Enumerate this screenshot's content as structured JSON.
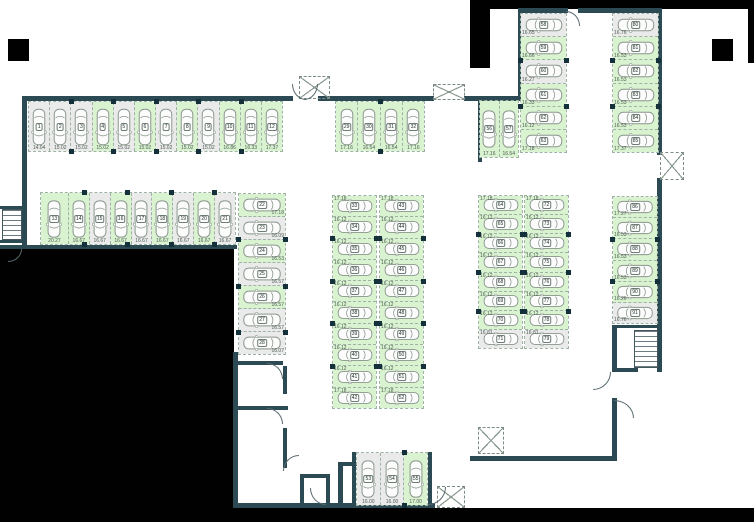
{
  "plan": {
    "type": "parking-floor-plan",
    "colors": {
      "available_stall": "#d9f2cf",
      "occupied_stall": "#eaeaea",
      "wall": "#2c4a54",
      "outside": "#010101",
      "floor": "#ffffff"
    },
    "groups": [
      {
        "id": "row-top-left",
        "dir": "row",
        "orient": "v",
        "x": 28,
        "y": 101,
        "w": 255,
        "h": 51,
        "sizePos": "bottom",
        "stalls": [
          {
            "n": "1",
            "size": "14.04",
            "green": false
          },
          {
            "n": "2",
            "size": "15.02",
            "green": false
          },
          {
            "n": "3",
            "size": "15.02",
            "green": false
          },
          {
            "n": "4",
            "size": "15.02",
            "green": true
          },
          {
            "n": "5",
            "size": "15.02",
            "green": false
          },
          {
            "n": "6",
            "size": "15.02",
            "green": true
          },
          {
            "n": "7",
            "size": "15.02",
            "green": false
          },
          {
            "n": "8",
            "size": "15.02",
            "green": true
          },
          {
            "n": "9",
            "size": "15.02",
            "green": false
          },
          {
            "n": "10",
            "size": "16.86",
            "green": true
          },
          {
            "n": "11",
            "size": "16.33",
            "green": true
          },
          {
            "n": "12",
            "size": "17.37",
            "green": true
          }
        ]
      },
      {
        "id": "row-second-left",
        "dir": "row",
        "orient": "v",
        "x": 40,
        "y": 192,
        "w": 196,
        "h": 53,
        "sizePos": "bottom",
        "stalls": [
          {
            "n": "13",
            "size": "20.27",
            "green": true,
            "f": 1.35
          },
          {
            "n": "14",
            "size": "16.67",
            "green": true
          },
          {
            "n": "15",
            "size": "16.67",
            "green": false
          },
          {
            "n": "16",
            "size": "16.67",
            "green": true
          },
          {
            "n": "17",
            "size": "16.67",
            "green": false
          },
          {
            "n": "18",
            "size": "16.67",
            "green": true
          },
          {
            "n": "19",
            "size": "16.67",
            "green": false
          },
          {
            "n": "20",
            "size": "16.67",
            "green": true
          },
          {
            "n": "21",
            "size": "16.67",
            "green": false
          }
        ]
      },
      {
        "id": "col-left",
        "dir": "col",
        "orient": "h",
        "x": 238,
        "y": 193,
        "w": 48,
        "h": 162,
        "sizePos": "br",
        "stalls": [
          {
            "n": "22",
            "size": "17.18",
            "green": true
          },
          {
            "n": "23",
            "size": "16.09",
            "green": false
          },
          {
            "n": "24",
            "size": "16.53",
            "green": true
          },
          {
            "n": "25",
            "size": "16.57",
            "green": false
          },
          {
            "n": "26",
            "size": "16.57",
            "green": true
          },
          {
            "n": "27",
            "size": "16.57",
            "green": false
          },
          {
            "n": "28",
            "size": "16.07",
            "green": false
          }
        ]
      },
      {
        "id": "row-mid-top",
        "dir": "row",
        "orient": "v",
        "x": 335,
        "y": 101,
        "w": 90,
        "h": 51,
        "sizePos": "bottom",
        "stalls": [
          {
            "n": "29",
            "size": "17.16",
            "green": true
          },
          {
            "n": "30",
            "size": "16.54",
            "green": true
          },
          {
            "n": "31",
            "size": "16.54",
            "green": true
          },
          {
            "n": "32",
            "size": "17.16",
            "green": true
          }
        ]
      },
      {
        "id": "col-mid-a",
        "dir": "col",
        "orient": "h",
        "x": 332,
        "y": 195,
        "w": 45,
        "h": 214,
        "sizePos": "tl",
        "stalls": [
          {
            "n": "33",
            "size": "17.18",
            "green": true
          },
          {
            "n": "34",
            "size": "16.12",
            "green": true
          },
          {
            "n": "35",
            "size": "16.12",
            "green": true
          },
          {
            "n": "36",
            "size": "16.12",
            "green": true
          },
          {
            "n": "37",
            "size": "16.12",
            "green": true
          },
          {
            "n": "38",
            "size": "16.12",
            "green": true
          },
          {
            "n": "39",
            "size": "16.12",
            "green": true
          },
          {
            "n": "40",
            "size": "16.12",
            "green": true
          },
          {
            "n": "41",
            "size": "16.12",
            "green": true
          },
          {
            "n": "42",
            "size": "17.18",
            "green": true
          }
        ]
      },
      {
        "id": "col-mid-b",
        "dir": "col",
        "orient": "h",
        "x": 379,
        "y": 195,
        "w": 45,
        "h": 214,
        "sizePos": "tl",
        "stalls": [
          {
            "n": "43",
            "size": "17.18",
            "green": true
          },
          {
            "n": "44",
            "size": "16.12",
            "green": true
          },
          {
            "n": "45",
            "size": "16.12",
            "green": true
          },
          {
            "n": "46",
            "size": "16.12",
            "green": true
          },
          {
            "n": "47",
            "size": "16.12",
            "green": true
          },
          {
            "n": "48",
            "size": "16.12",
            "green": true
          },
          {
            "n": "49",
            "size": "16.12",
            "green": true
          },
          {
            "n": "50",
            "size": "16.12",
            "green": true
          },
          {
            "n": "51",
            "size": "16.12",
            "green": true
          },
          {
            "n": "52",
            "size": "17.18",
            "green": true
          }
        ]
      },
      {
        "id": "row-bottom-center",
        "dir": "row",
        "orient": "v",
        "x": 356,
        "y": 452,
        "w": 72,
        "h": 54,
        "sizePos": "bottom",
        "stalls": [
          {
            "n": "53",
            "size": "16.00",
            "green": false
          },
          {
            "n": "54",
            "size": "16.00",
            "green": false
          },
          {
            "n": "55",
            "size": "17.00",
            "green": true
          }
        ]
      },
      {
        "id": "pair-top-right",
        "dir": "row",
        "orient": "v",
        "x": 479,
        "y": 100,
        "w": 40,
        "h": 58,
        "sizePos": "bottom",
        "stalls": [
          {
            "n": "56",
            "size": "17.16",
            "green": true
          },
          {
            "n": "57",
            "size": "16.54",
            "green": true
          }
        ]
      },
      {
        "id": "col-wing-left",
        "dir": "col",
        "orient": "h",
        "x": 520,
        "y": 13,
        "w": 47,
        "h": 140,
        "sizePos": "bl",
        "stalls": [
          {
            "n": "58",
            "size": "16.65",
            "green": false
          },
          {
            "n": "59",
            "size": "16.66",
            "green": true
          },
          {
            "n": "60",
            "size": "16.27",
            "green": false
          },
          {
            "n": "61",
            "size": "16.33",
            "green": true
          },
          {
            "n": "62",
            "size": "16.12",
            "green": true
          },
          {
            "n": "63",
            "size": "17.18",
            "green": true
          }
        ]
      },
      {
        "id": "col-wing-right",
        "dir": "col",
        "orient": "h",
        "x": 612,
        "y": 13,
        "w": 47,
        "h": 140,
        "sizePos": "bl",
        "stalls": [
          {
            "n": "80",
            "size": "16.76",
            "green": false
          },
          {
            "n": "81",
            "size": "16.53",
            "green": true
          },
          {
            "n": "82",
            "size": "16.53",
            "green": true
          },
          {
            "n": "83",
            "size": "16.53",
            "green": true
          },
          {
            "n": "84",
            "size": "16.53",
            "green": true
          },
          {
            "n": "85",
            "size": "17.37",
            "green": true
          }
        ]
      },
      {
        "id": "col-right-a",
        "dir": "col",
        "orient": "h",
        "x": 478,
        "y": 195,
        "w": 45,
        "h": 154,
        "sizePos": "tl",
        "stalls": [
          {
            "n": "64",
            "size": "17.18",
            "green": true
          },
          {
            "n": "65",
            "size": "16.12",
            "green": true
          },
          {
            "n": "66",
            "size": "16.12",
            "green": true
          },
          {
            "n": "67",
            "size": "16.12",
            "green": true
          },
          {
            "n": "68",
            "size": "16.12",
            "green": true
          },
          {
            "n": "69",
            "size": "16.12",
            "green": true
          },
          {
            "n": "70",
            "size": "16.12",
            "green": true
          },
          {
            "n": "71",
            "size": "16.81",
            "green": false
          }
        ]
      },
      {
        "id": "col-right-b",
        "dir": "col",
        "orient": "h",
        "x": 524,
        "y": 195,
        "w": 45,
        "h": 154,
        "sizePos": "tl",
        "stalls": [
          {
            "n": "72",
            "size": "17.18",
            "green": true
          },
          {
            "n": "73",
            "size": "16.12",
            "green": true
          },
          {
            "n": "74",
            "size": "16.12",
            "green": true
          },
          {
            "n": "75",
            "size": "16.12",
            "green": true
          },
          {
            "n": "76",
            "size": "16.12",
            "green": true
          },
          {
            "n": "77",
            "size": "16.12",
            "green": true
          },
          {
            "n": "78",
            "size": "16.12",
            "green": true
          },
          {
            "n": "79",
            "size": "16.81",
            "green": false
          }
        ]
      },
      {
        "id": "col-far-right",
        "dir": "col",
        "orient": "h",
        "x": 612,
        "y": 196,
        "w": 46,
        "h": 128,
        "sizePos": "bl",
        "stalls": [
          {
            "n": "86",
            "size": "17.27",
            "green": true
          },
          {
            "n": "87",
            "size": "16.53",
            "green": true
          },
          {
            "n": "88",
            "size": "16.53",
            "green": true
          },
          {
            "n": "89",
            "size": "16.53",
            "green": true
          },
          {
            "n": "90",
            "size": "16.26",
            "green": true
          },
          {
            "n": "91",
            "size": "16.76",
            "green": false
          }
        ]
      }
    ],
    "black_regions": [
      [
        0,
        249,
        234,
        273
      ],
      [
        0,
        508,
        754,
        14
      ],
      [
        488,
        0,
        266,
        9
      ],
      [
        470,
        0,
        20,
        68
      ],
      [
        8,
        39,
        21,
        22
      ],
      [
        712,
        39,
        21,
        22
      ],
      [
        748,
        8,
        6,
        55
      ]
    ],
    "walls": [
      [
        22,
        96,
        271,
        5
      ],
      [
        22,
        96,
        5,
        152
      ],
      [
        0,
        245,
        237,
        4
      ],
      [
        318,
        96,
        116,
        5
      ],
      [
        464,
        96,
        58,
        5
      ],
      [
        478,
        96,
        4,
        66
      ],
      [
        518,
        8,
        50,
        5
      ],
      [
        578,
        8,
        84,
        5
      ],
      [
        518,
        8,
        5,
        92
      ],
      [
        657,
        8,
        5,
        147
      ],
      [
        657,
        178,
        5,
        150
      ],
      [
        612,
        325,
        5,
        47
      ],
      [
        657,
        325,
        5,
        47
      ],
      [
        612,
        325,
        48,
        3
      ],
      [
        612,
        368,
        26,
        4
      ],
      [
        612,
        398,
        5,
        62
      ],
      [
        470,
        456,
        147,
        5
      ],
      [
        352,
        452,
        4,
        56
      ],
      [
        428,
        452,
        4,
        56
      ],
      [
        237,
        503,
        198,
        5
      ],
      [
        338,
        462,
        5,
        44
      ],
      [
        338,
        462,
        22,
        4
      ],
      [
        233,
        352,
        5,
        156
      ],
      [
        233,
        361,
        50,
        4
      ],
      [
        233,
        406,
        55,
        4
      ],
      [
        283,
        366,
        4,
        28
      ],
      [
        283,
        428,
        4,
        40
      ],
      [
        300,
        474,
        4,
        33
      ],
      [
        300,
        474,
        30,
        4
      ],
      [
        326,
        474,
        4,
        33
      ],
      [
        0,
        206,
        22,
        3
      ],
      [
        0,
        240,
        22,
        3
      ]
    ],
    "shafts": [
      [
        299,
        76,
        31,
        23
      ],
      [
        433,
        84,
        32,
        16
      ],
      [
        660,
        152,
        24,
        28
      ],
      [
        478,
        427,
        26,
        27
      ],
      [
        437,
        486,
        28,
        22
      ]
    ],
    "stairs": [
      [
        2,
        209,
        20,
        31
      ],
      [
        634,
        330,
        24,
        38
      ]
    ],
    "doors": [
      [
        292,
        84,
        14,
        16,
        "bl"
      ],
      [
        304,
        84,
        14,
        16,
        "br"
      ],
      [
        566,
        11,
        14,
        15,
        "tr"
      ],
      [
        593,
        372,
        18,
        18,
        "br"
      ],
      [
        614,
        400,
        20,
        18,
        "tr"
      ],
      [
        428,
        487,
        18,
        18,
        "br"
      ],
      [
        310,
        488,
        16,
        17,
        "bl"
      ],
      [
        267,
        363,
        16,
        16,
        "tr"
      ],
      [
        267,
        408,
        16,
        16,
        "tr"
      ],
      [
        283,
        455,
        16,
        16,
        "tl"
      ],
      [
        8,
        249,
        14,
        13,
        "br"
      ]
    ]
  }
}
